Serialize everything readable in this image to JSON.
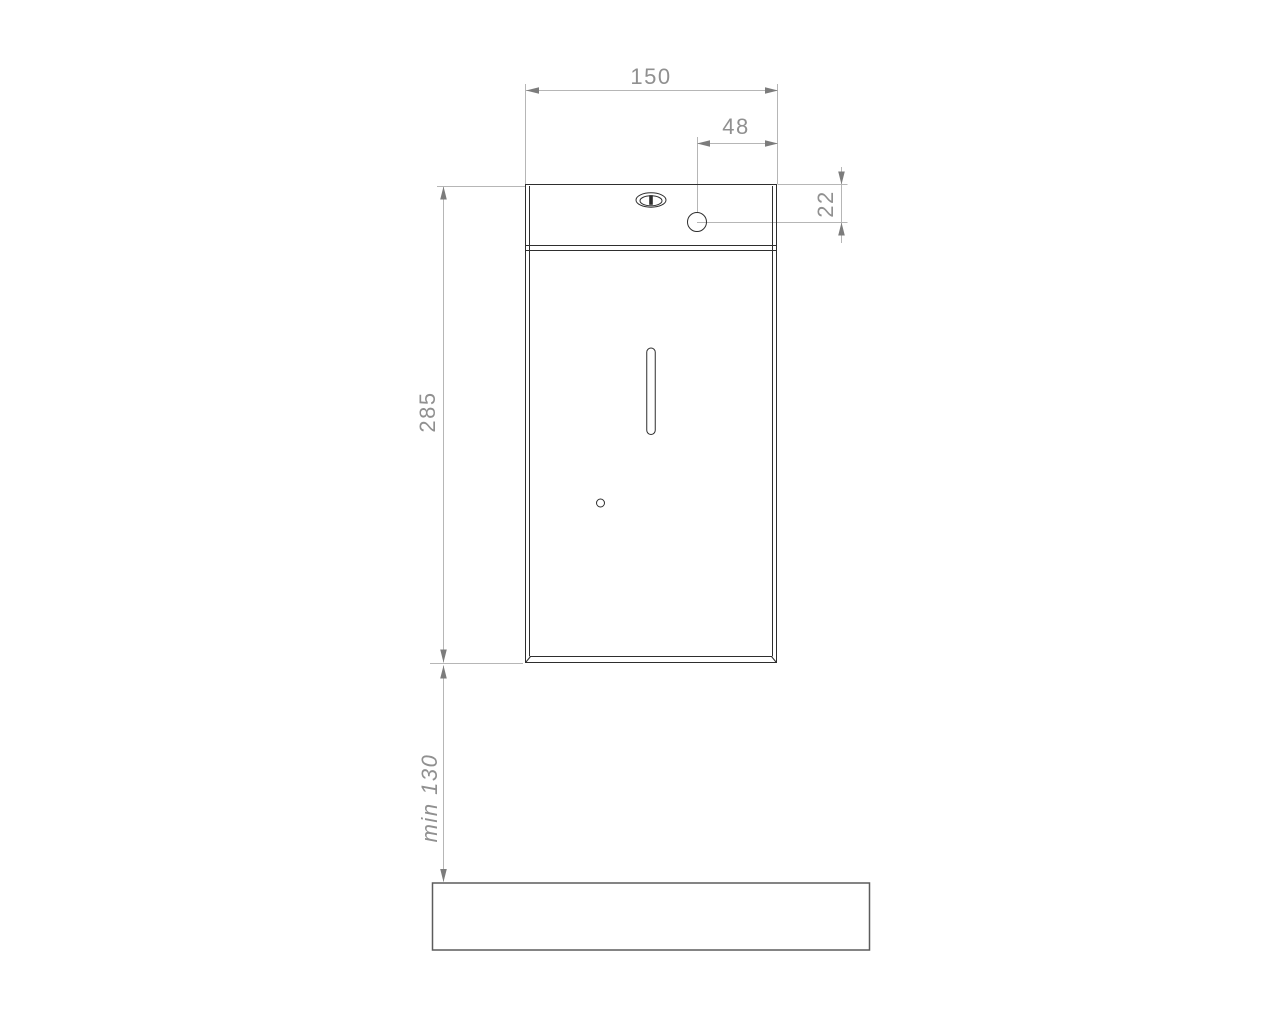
{
  "drawing": {
    "kind": "technical-drawing",
    "view": "front-elevation-dispenser-above-counter",
    "labels": {
      "width": "150",
      "hole_offset": "48",
      "hole_inset": "22",
      "height": "285",
      "clearance": "min 130"
    },
    "colors": {
      "background": "#ffffff",
      "device_line": "#2e2e2e",
      "dimension_line": "#b6b6b6",
      "arrow": "#7c7c7c",
      "label_text": "#909090",
      "surface_line": "#5c5c5c"
    }
  }
}
